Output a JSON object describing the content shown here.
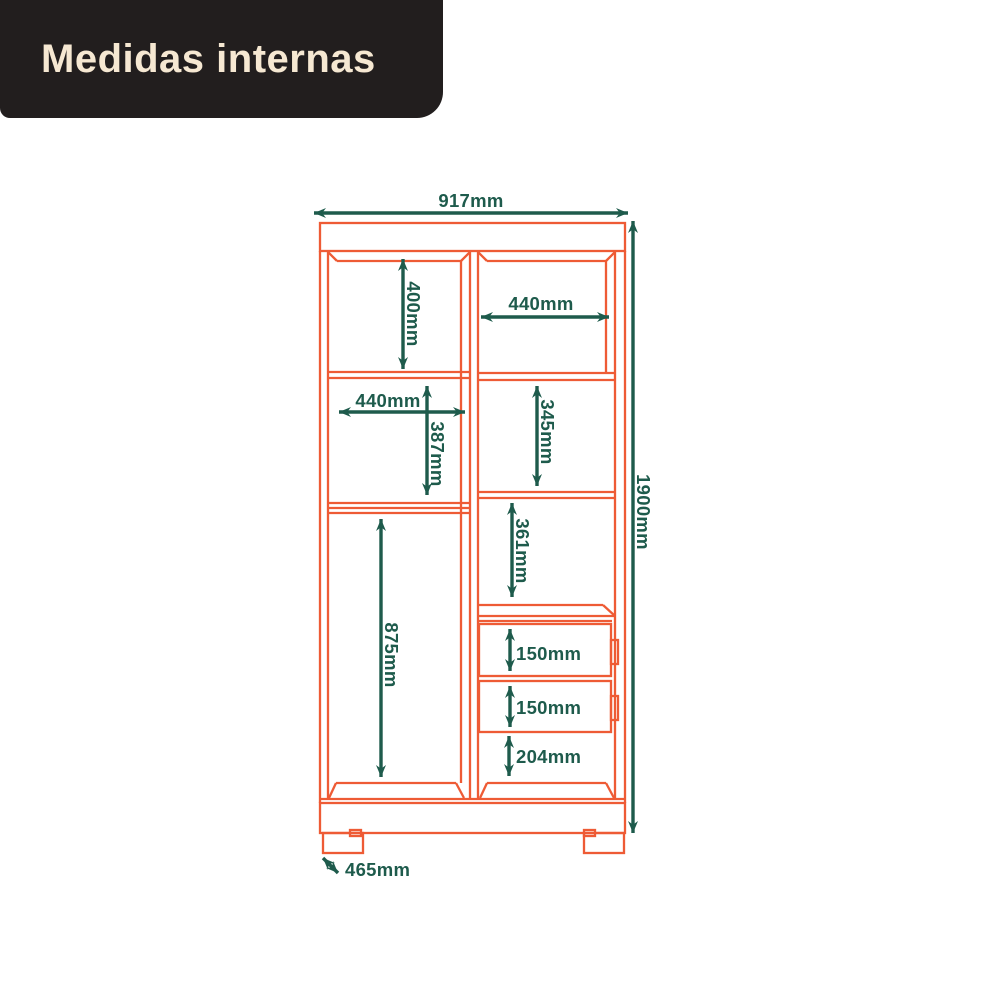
{
  "banner": {
    "title": "Medidas internas"
  },
  "colors": {
    "outline_orange": "#EE5B35",
    "dimension_green": "#1E5B4C",
    "banner_background": "#221E1E",
    "banner_text": "#F6E8D2",
    "page_background": "#FFFFFF"
  },
  "diagram": {
    "dimensions": {
      "total_width": "917mm",
      "total_height": "1900mm",
      "base_depth": "465mm",
      "left_top_compartment_height": "400mm",
      "right_top_compartment_width": "440mm",
      "left_middle_compartment_width": "440mm",
      "left_middle_compartment_height": "387mm",
      "right_upper_middle_compartment_height": "345mm",
      "right_lower_middle_compartment_height": "361mm",
      "left_bottom_compartment_height": "875mm",
      "upper_drawer_height": "150mm",
      "lower_drawer_height": "150mm",
      "right_bottom_compartment_height": "204mm"
    }
  }
}
